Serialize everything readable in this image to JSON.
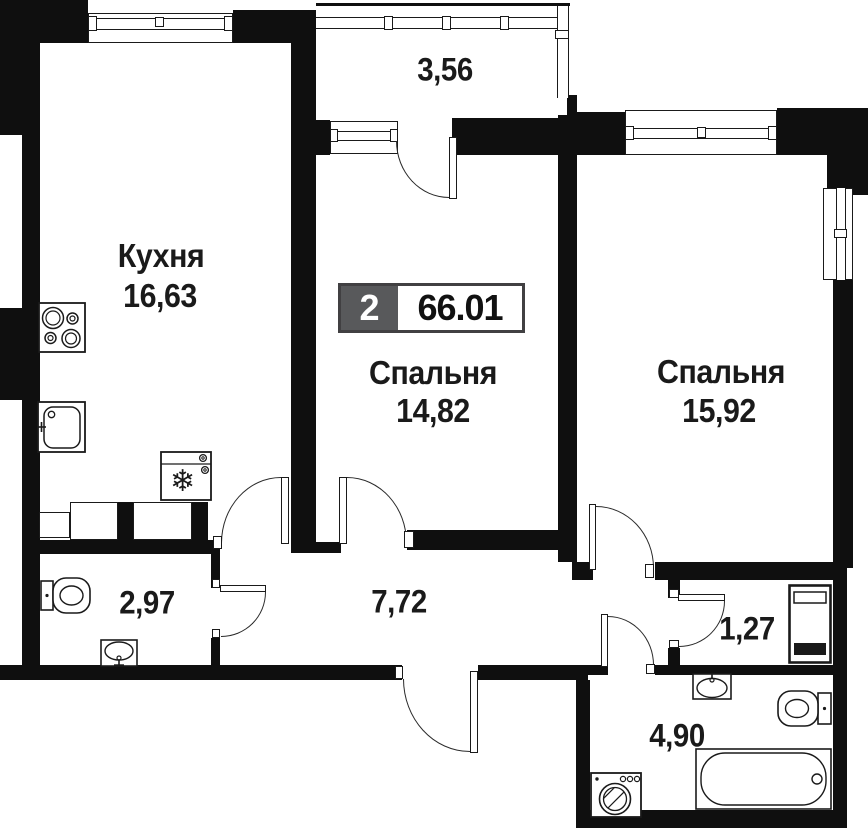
{
  "floor_plan": {
    "badge": {
      "rooms_count": "2",
      "total_area": "66.01"
    },
    "rooms": {
      "kitchen": {
        "name": "Кухня",
        "area": "16,63"
      },
      "bedroom1": {
        "name": "Спальня",
        "area": "14,82"
      },
      "bedroom2": {
        "name": "Спальня",
        "area": "15,92"
      },
      "balcony": {
        "area": "3,56"
      },
      "bathroom_small": {
        "area": "2,97"
      },
      "hallway": {
        "area": "7,72"
      },
      "wardrobe_nook": {
        "area": "1,27"
      },
      "bathroom_large": {
        "area": "4,90"
      }
    },
    "icons": {
      "snowflake": "❄"
    },
    "colors": {
      "wall": "#0f0f0f",
      "badge_fill": "#58595b",
      "badge_border": "#414042",
      "line": "#1a1a1a"
    }
  }
}
